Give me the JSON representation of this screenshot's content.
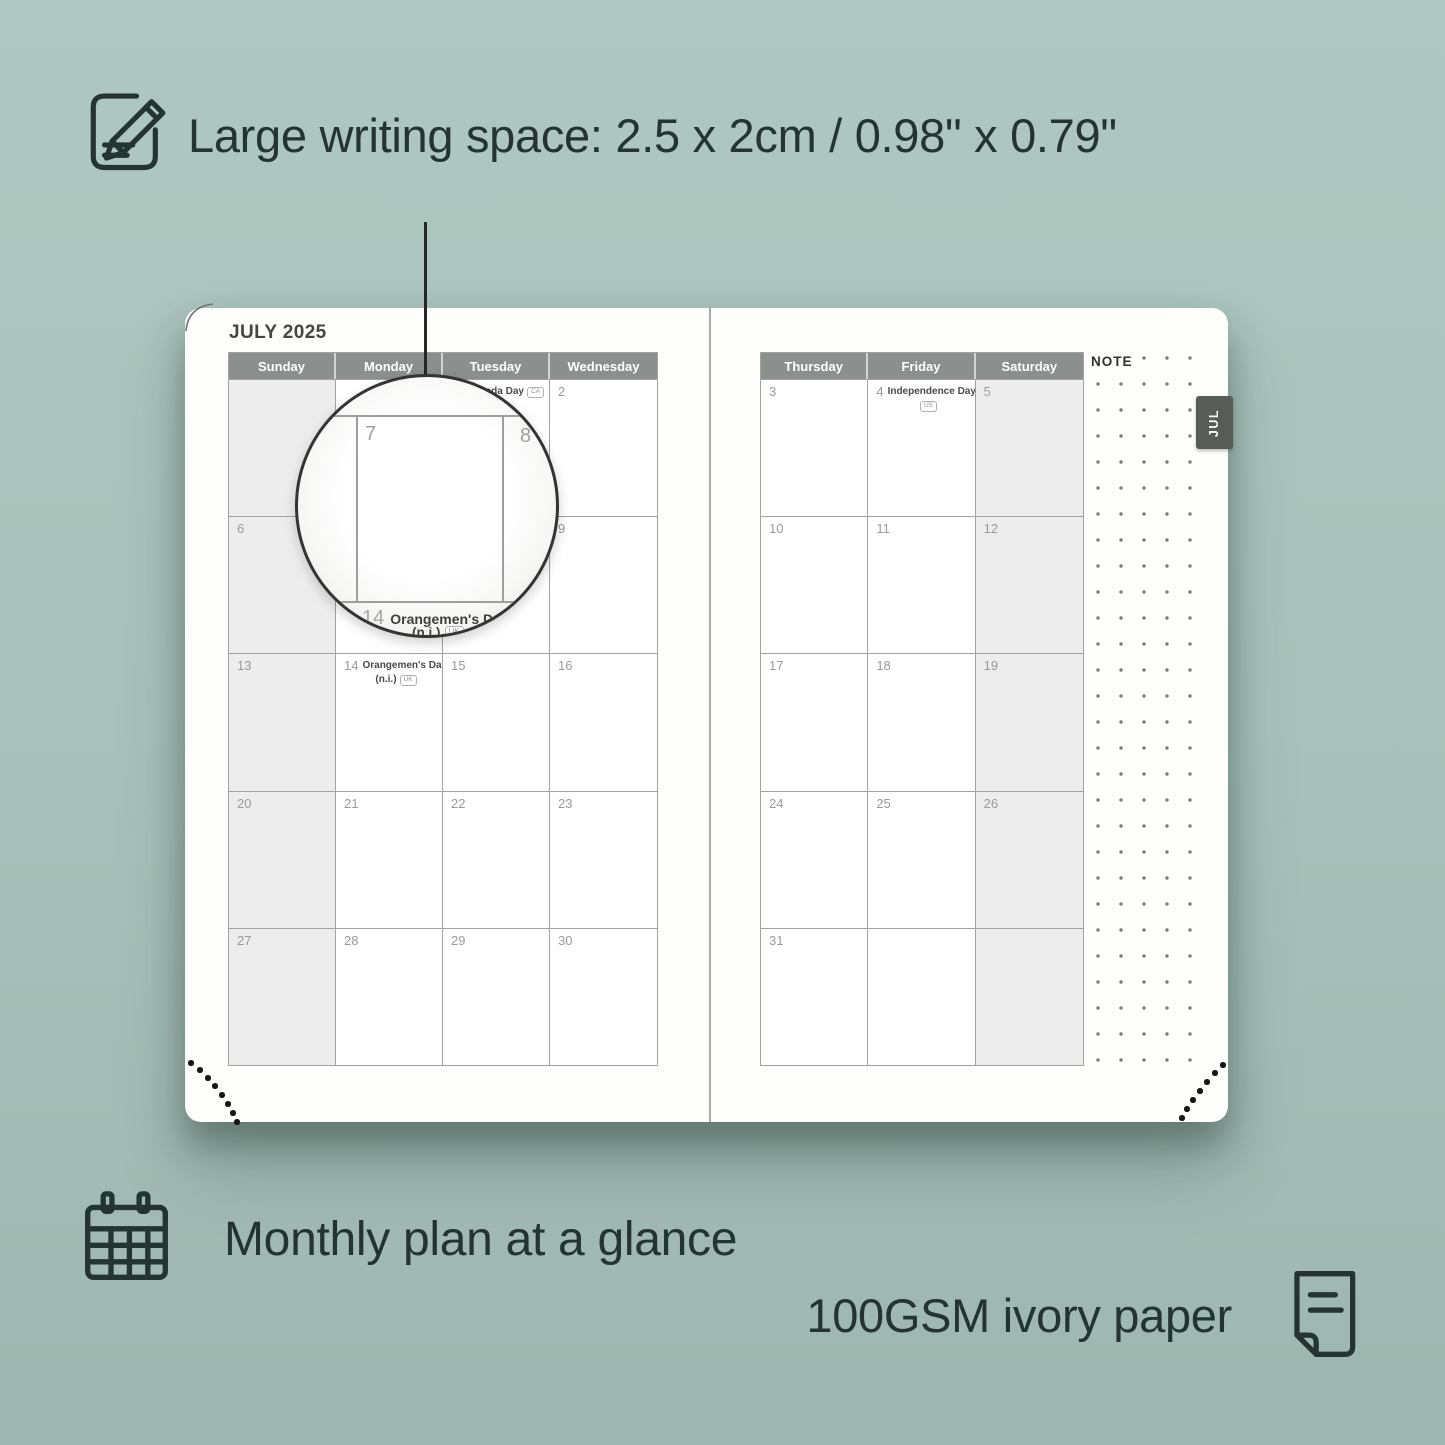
{
  "features": {
    "writing_space": {
      "label": "Large writing space: 2.5 x 2cm / 0.98\" x 0.79\"",
      "icon": "note-pencil-icon"
    },
    "monthly_plan": {
      "label": "Monthly plan at a glance",
      "icon": "calendar-icon"
    },
    "paper": {
      "label": "100GSM ivory paper",
      "icon": "paper-icon"
    }
  },
  "planner": {
    "title": "JULY 2025",
    "note_label": "NOTE",
    "tab_label": "JUL",
    "left_page": {
      "day_headers": [
        "Sunday",
        "Monday",
        "Tuesday",
        "Wednesday"
      ],
      "weeks": [
        [
          {
            "shaded": true
          },
          {},
          {
            "day": "1",
            "holiday": "Canada Day",
            "badge": "CA",
            "badge_inline": true
          },
          {
            "day": "2"
          }
        ],
        [
          {
            "day": "6",
            "shaded": true
          },
          {
            "day": "7"
          },
          {
            "day": "8"
          },
          {
            "day": "9"
          }
        ],
        [
          {
            "day": "13",
            "shaded": true
          },
          {
            "day": "14",
            "holiday": "Orangemen's Day",
            "sub": "(n.i.)",
            "badge": "UK"
          },
          {
            "day": "15"
          },
          {
            "day": "16"
          }
        ],
        [
          {
            "day": "20",
            "shaded": true
          },
          {
            "day": "21"
          },
          {
            "day": "22"
          },
          {
            "day": "23"
          }
        ],
        [
          {
            "day": "27",
            "shaded": true
          },
          {
            "day": "28"
          },
          {
            "day": "29"
          },
          {
            "day": "30"
          }
        ]
      ]
    },
    "right_page": {
      "day_headers": [
        "Thursday",
        "Friday",
        "Saturday"
      ],
      "weeks": [
        [
          {
            "day": "3"
          },
          {
            "day": "4",
            "holiday": "Independence Day",
            "badge": "US"
          },
          {
            "day": "5",
            "shaded": true
          }
        ],
        [
          {
            "day": "10"
          },
          {
            "day": "11"
          },
          {
            "day": "12",
            "shaded": true
          }
        ],
        [
          {
            "day": "17"
          },
          {
            "day": "18"
          },
          {
            "day": "19",
            "shaded": true
          }
        ],
        [
          {
            "day": "24"
          },
          {
            "day": "25"
          },
          {
            "day": "26",
            "shaded": true
          }
        ],
        [
          {
            "day": "31"
          },
          {},
          {
            "shaded": true
          }
        ]
      ]
    },
    "magnifier": {
      "day_large": "7",
      "day_next": "8",
      "bottom_day": "14",
      "bottom_holiday": "Orangemen's Day",
      "bottom_detail": "(n.i.)",
      "bottom_badge": "UK"
    }
  },
  "colors": {
    "background": "#a9c2bb",
    "text_dark": "#243430",
    "page_white": "#fdfdfc",
    "header_gray": "#8b8f8d",
    "tab_gray": "#575c57",
    "weekend_shade": "#ededed",
    "grid_line": "#a2a2a2",
    "date_number": "#9a9a9a",
    "holiday_text": "#4a4a4a",
    "note_dot": "#7a7a7a",
    "corner_dot": "#161616"
  }
}
